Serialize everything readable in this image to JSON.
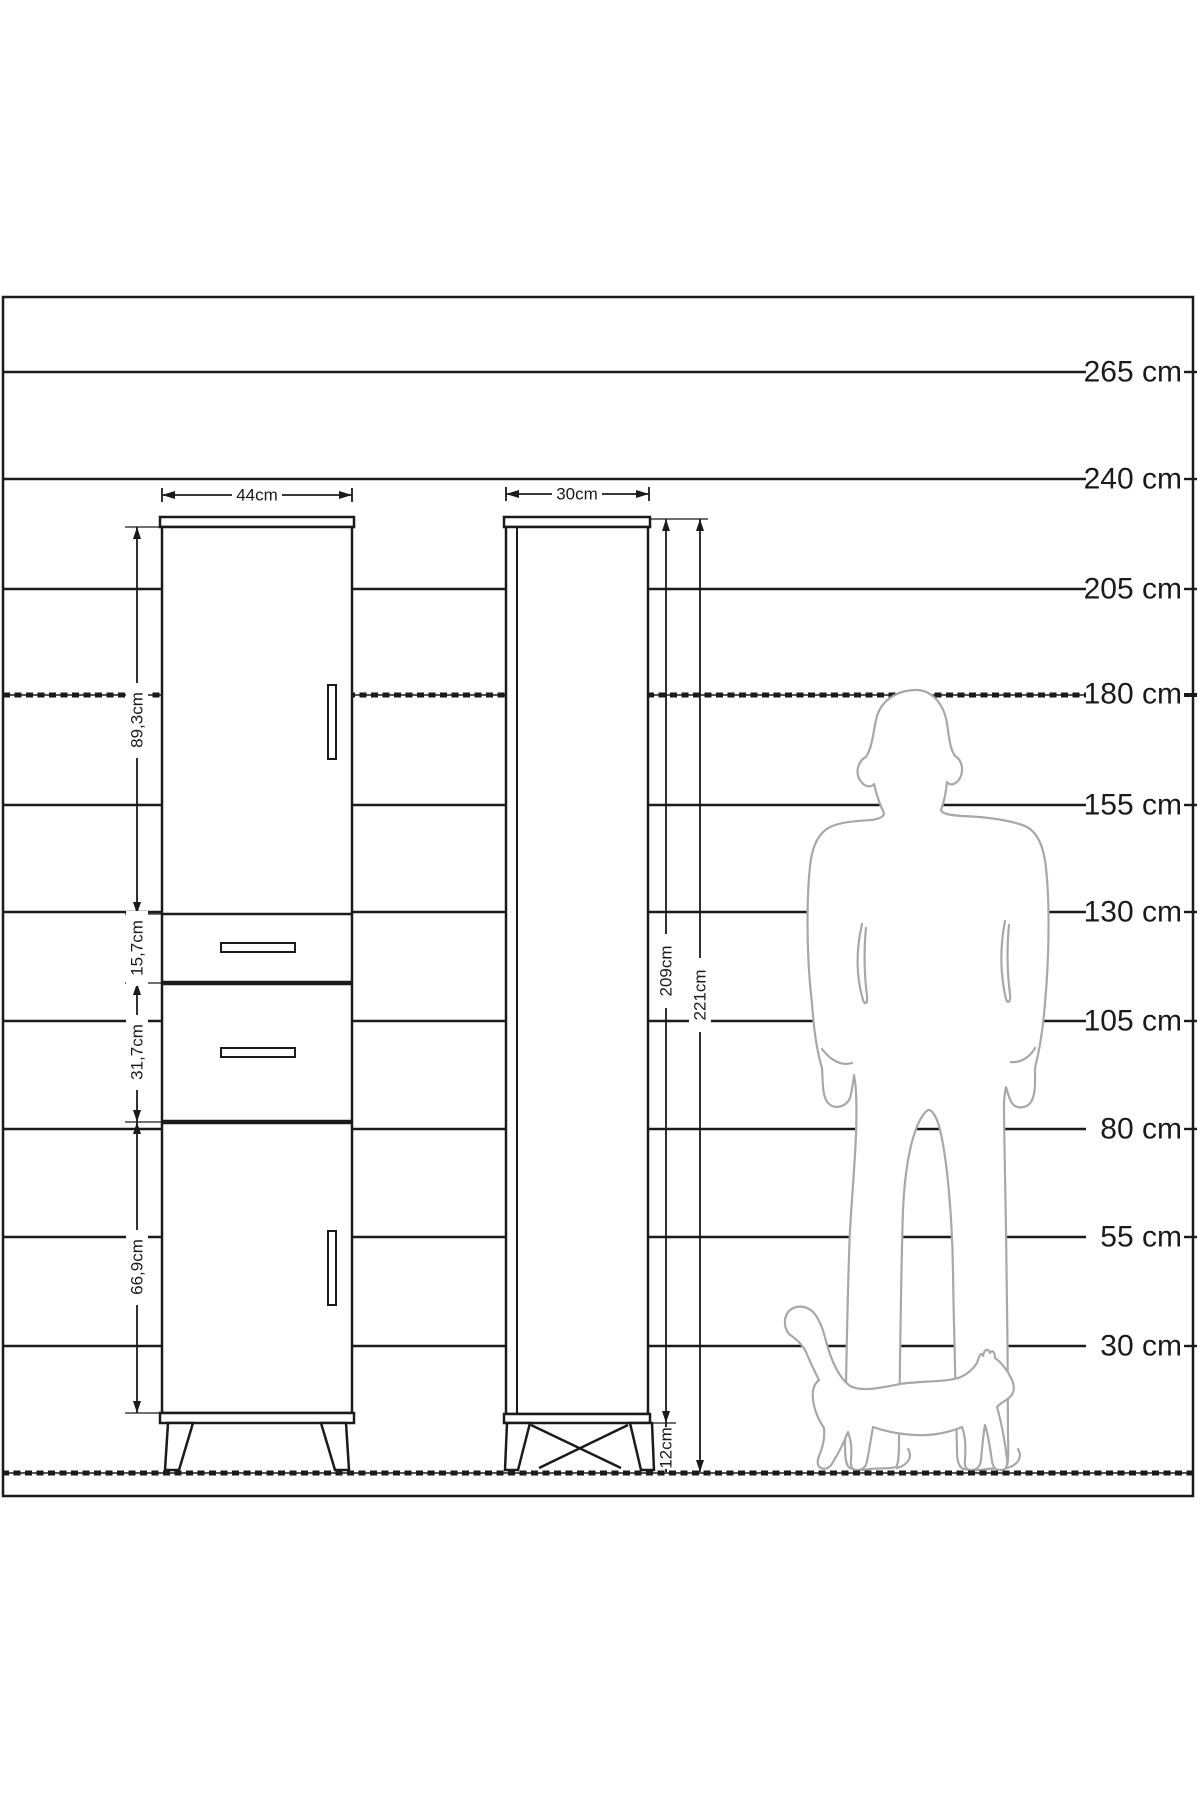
{
  "scale_labels": [
    "265 cm",
    "240 cm",
    "205 cm",
    "180 cm",
    "155 cm",
    "130 cm",
    "105 cm",
    "80 cm",
    "55 cm",
    "30 cm"
  ],
  "front_view": {
    "width_label": "44cm",
    "sections": [
      {
        "name": "upper-door",
        "height_label": "89,3cm"
      },
      {
        "name": "drawer-1",
        "height_label": "15,7cm"
      },
      {
        "name": "drawer-2",
        "height_label": "31,7cm"
      },
      {
        "name": "lower-door",
        "height_label": "66,9cm"
      }
    ]
  },
  "side_view": {
    "depth_label": "30cm",
    "body_height_label": "209cm",
    "total_height_label": "221cm",
    "leg_height_label": "12cm"
  },
  "colors": {
    "line": "#1b1b1b",
    "figure": "#a8a8a8",
    "background": "#ffffff"
  }
}
